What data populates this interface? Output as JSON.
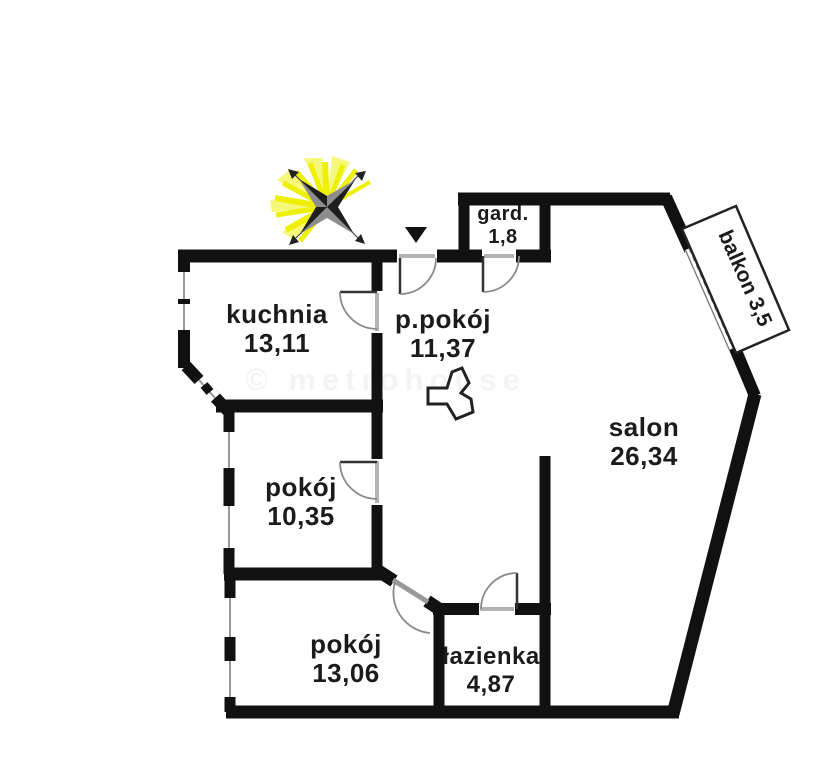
{
  "rooms": {
    "kuchnia": {
      "name": "kuchnia",
      "area": "13,11"
    },
    "p_pokoj": {
      "name": "p.pokój",
      "area": "11,37"
    },
    "gard": {
      "name": "gard.",
      "area": "1,8"
    },
    "salon": {
      "name": "salon",
      "area": "26,34"
    },
    "pokoj_10": {
      "name": "pokój",
      "area": "10,35"
    },
    "pokoj_13": {
      "name": "pokój",
      "area": "13,06"
    },
    "lazienka": {
      "name": "łazienka",
      "area": "4,87"
    },
    "balkon": {
      "label": "balkon 3,5"
    }
  },
  "watermark": "© metrohouse",
  "colors": {
    "wall": "#111111",
    "door_leaf": "#333333",
    "door_arc": "#8a8a8a",
    "threshold": "#b3b3b3",
    "window": "#999999",
    "compass_dark": "#1e1e1e",
    "compass_gray": "#8d8d8d",
    "ray_yellow": "#eef005",
    "ray_light": "#f6f87a",
    "background": "#ffffff"
  }
}
